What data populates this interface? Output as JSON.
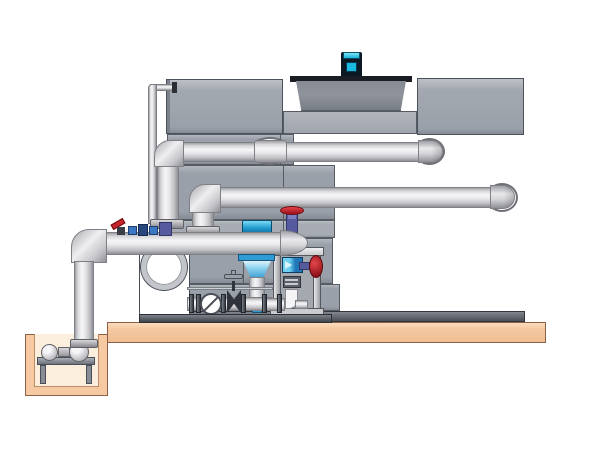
{
  "meta": {
    "type": "technical-illustration",
    "subject": "Cooling tower with pump skid, sump pit and piping",
    "visible_text": "none"
  },
  "palette": {
    "background": "#ffffff",
    "tank_gray": "#9aa0a9",
    "tank_gray_light": "#a7acb4",
    "tank_outline": "#565b64",
    "pipe_highlight": "#f5f5f7",
    "pipe_shadow": "#8f9095",
    "slab_tan": "#f6c9a2",
    "slab_outline": "#8a6146",
    "pit_interior": "#fbeedd",
    "motor_cyan": "#25c5ea",
    "motor_dark": "#0c1925",
    "valve_red": "#c6242b",
    "valve_purple": "#565a9e",
    "equipment_blue": "#2f9ad3",
    "equipment_blue_light": "#6fd0f0",
    "skid_white": "#ffffff",
    "outline_dark": "#4a4f57"
  },
  "components": [
    {
      "name": "cooling-tower-casing",
      "detail": "gray paneled tank body with seamed panels and base rail"
    },
    {
      "name": "fan-shroud",
      "detail": "tapered gray cylinder recessed between top panels"
    },
    {
      "name": "fan-motor",
      "detail": "dark motor with cyan cap and cyan front plate on shroud deck"
    },
    {
      "name": "upper-header-pipe",
      "detail": "horizontal pipe with left down-elbow, wall sleeve and right elbow into casing"
    },
    {
      "name": "middle-header-pipe",
      "detail": "horizontal pipe with left down-elbow and right elbow into casing"
    },
    {
      "name": "suction-pipe",
      "detail": "lower horizontal pipe with domed end cap, left elbow dropping into sump pit"
    },
    {
      "name": "overflow-pipe",
      "detail": "thin vertical pipe along left side of casing"
    },
    {
      "name": "inline-pump",
      "detail": "vertical pump with blue motor above pipe and blue cone below"
    },
    {
      "name": "cap-top-valve",
      "detail": "red handwheel valve with purple body on pipe end cap"
    },
    {
      "name": "makeup-valve-cluster",
      "detail": "small red lever valve with blue and purple fittings on suction pipe"
    },
    {
      "name": "pump-housing",
      "detail": "white casing with large circular suction flange"
    },
    {
      "name": "check-valve",
      "detail": "white disc with diagonal slash on ground pipe"
    },
    {
      "name": "gate-valve",
      "detail": "dark bow-tie valve with tee handle on ground pipe"
    },
    {
      "name": "equipment-frame",
      "detail": "frame rack with blue unit, gauge panel, white drain elbow and red handwheel"
    },
    {
      "name": "concrete-slab",
      "detail": "tan slab supporting tower and skid"
    },
    {
      "name": "sump-pit",
      "detail": "tan pit below slab at left"
    },
    {
      "name": "sump-pump",
      "detail": "two-sphere pump on stand inside pit, fed by drop pipe"
    }
  ]
}
